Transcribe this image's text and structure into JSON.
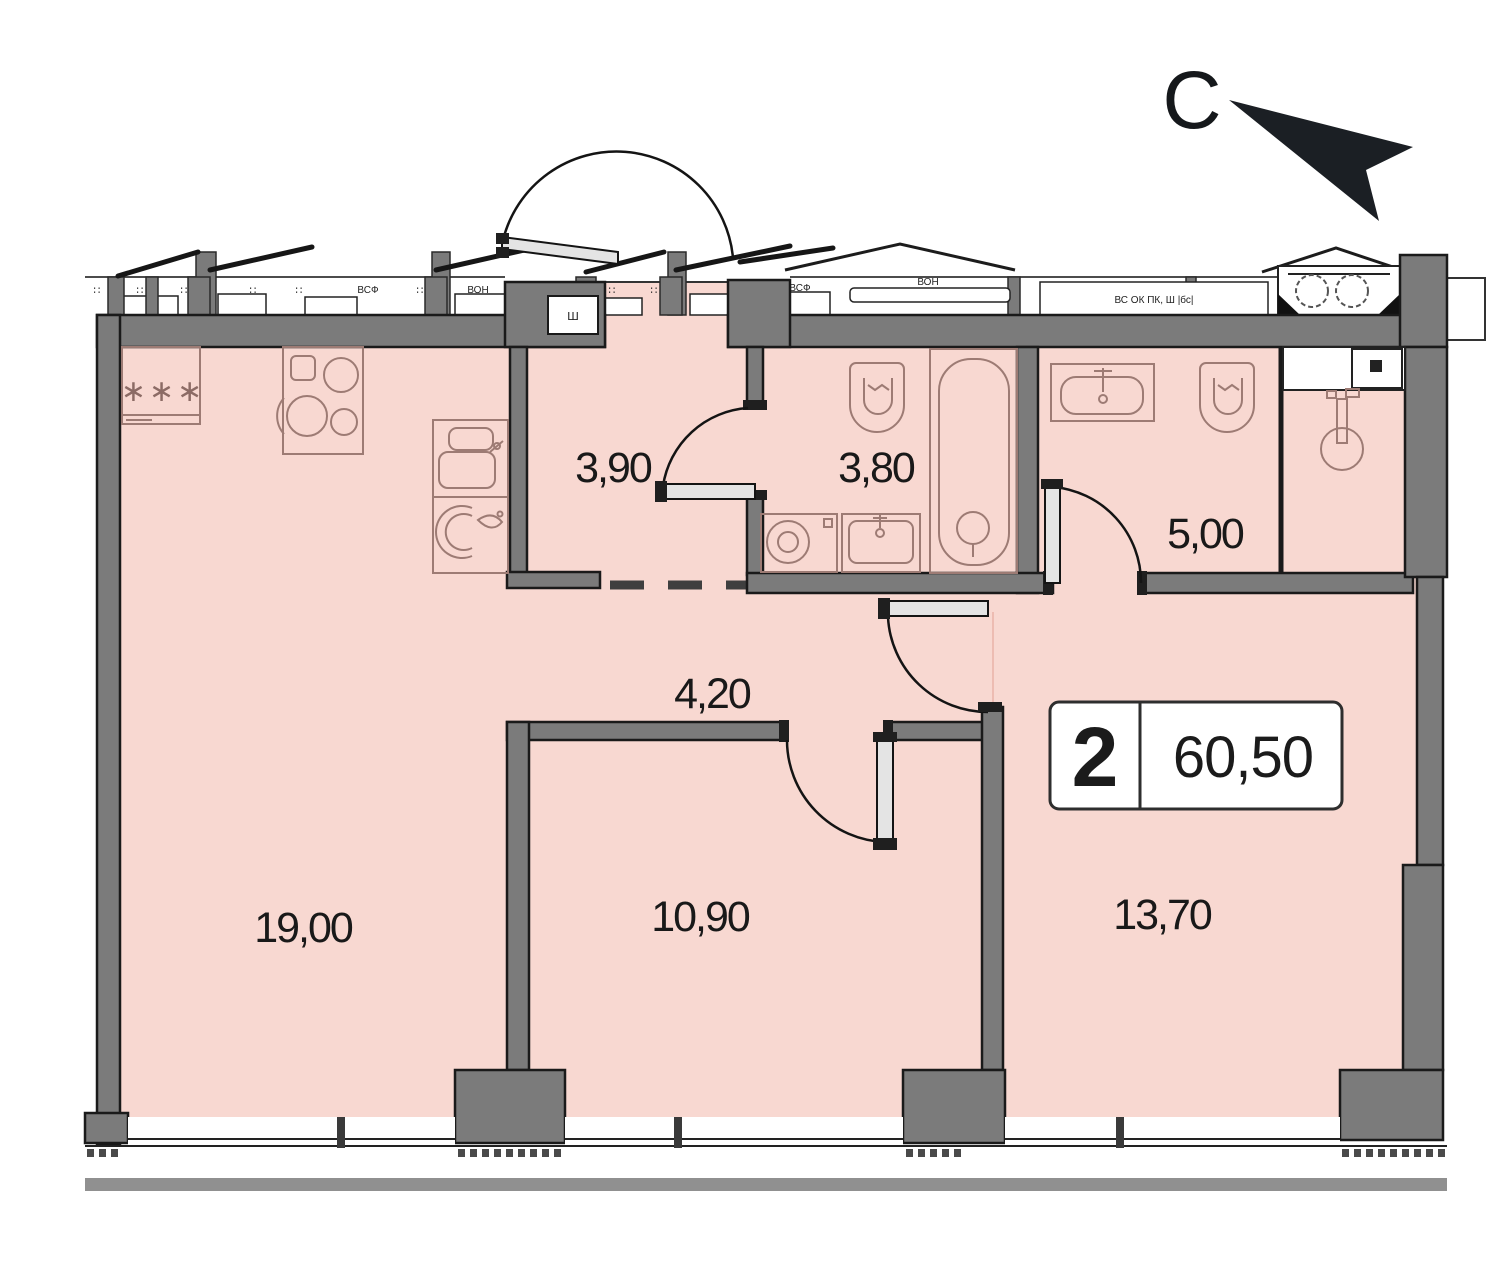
{
  "meta": {
    "type": "apartment-floor-plan"
  },
  "north": {
    "label": "С"
  },
  "summary_badge": {
    "rooms": "2",
    "area": "60,50"
  },
  "rooms": [
    {
      "id": "hallway",
      "label": "3,90"
    },
    {
      "id": "bathroom",
      "label": "3,80"
    },
    {
      "id": "toilet",
      "label": "5,00"
    },
    {
      "id": "corridor",
      "label": "4,20"
    },
    {
      "id": "kitchen-living-room",
      "label": "19,00"
    },
    {
      "id": "bedroom",
      "label": "10,90"
    },
    {
      "id": "living-room",
      "label": "13,70"
    }
  ],
  "fixtures": {
    "fridge_mark": "∗∗∗"
  },
  "facade": {
    "t1": "ВСФ",
    "t2": "ВОН",
    "t3": "ШКФ ИТ",
    "t4": "ВСФ",
    "t5": "ВОН",
    "vent_label": "ВС ОК ПК, Ш |бс|",
    "entrance_inset": "Ш"
  },
  "colors": {
    "floor": "#f8d8d1",
    "wall": "#7b7b7b",
    "wall_edge": "#1a1a1a",
    "fixture_line": "#9d7b74",
    "dash": "#3f3f3f",
    "plinth_bar": "#909090",
    "ink": "#191919"
  }
}
